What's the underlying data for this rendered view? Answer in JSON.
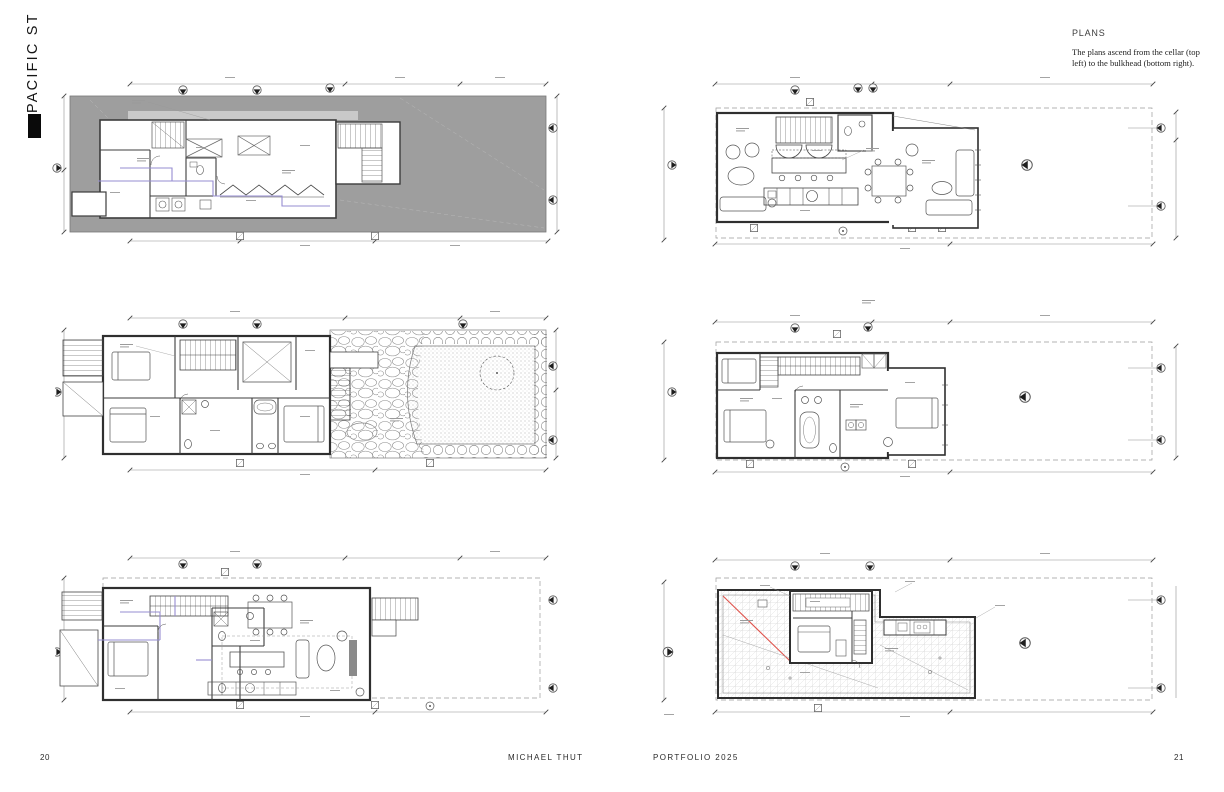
{
  "sidebar": {
    "project_label": "PACIFIC ST"
  },
  "commentary": {
    "heading": "PLANS",
    "body": "The plans ascend from the cellar (top left) to the bulkhead (bottom right)."
  },
  "footer": {
    "left_page_number": "20",
    "author": "MICHAEL THUT",
    "portfolio": "PORTFOLIO 2025",
    "right_page_number": "21"
  },
  "figures": {
    "top_left": {
      "subject": "cellar plan"
    },
    "top_right": {
      "subject": "floor plan"
    },
    "middle_left": {
      "subject": "floor plan with garden"
    },
    "middle_right": {
      "subject": "floor plan"
    },
    "bottom_left": {
      "subject": "floor plan"
    },
    "bottom_right": {
      "subject": "roof and bulkhead plan"
    }
  },
  "colors": {
    "paper": "#ffffff",
    "site_gray": "#9e9e9e",
    "linework": "#3c3c3c",
    "dimension_gray": "#8f8f8f",
    "plumbing_purple": "#968cd2",
    "accent_red": "#e0554e"
  }
}
